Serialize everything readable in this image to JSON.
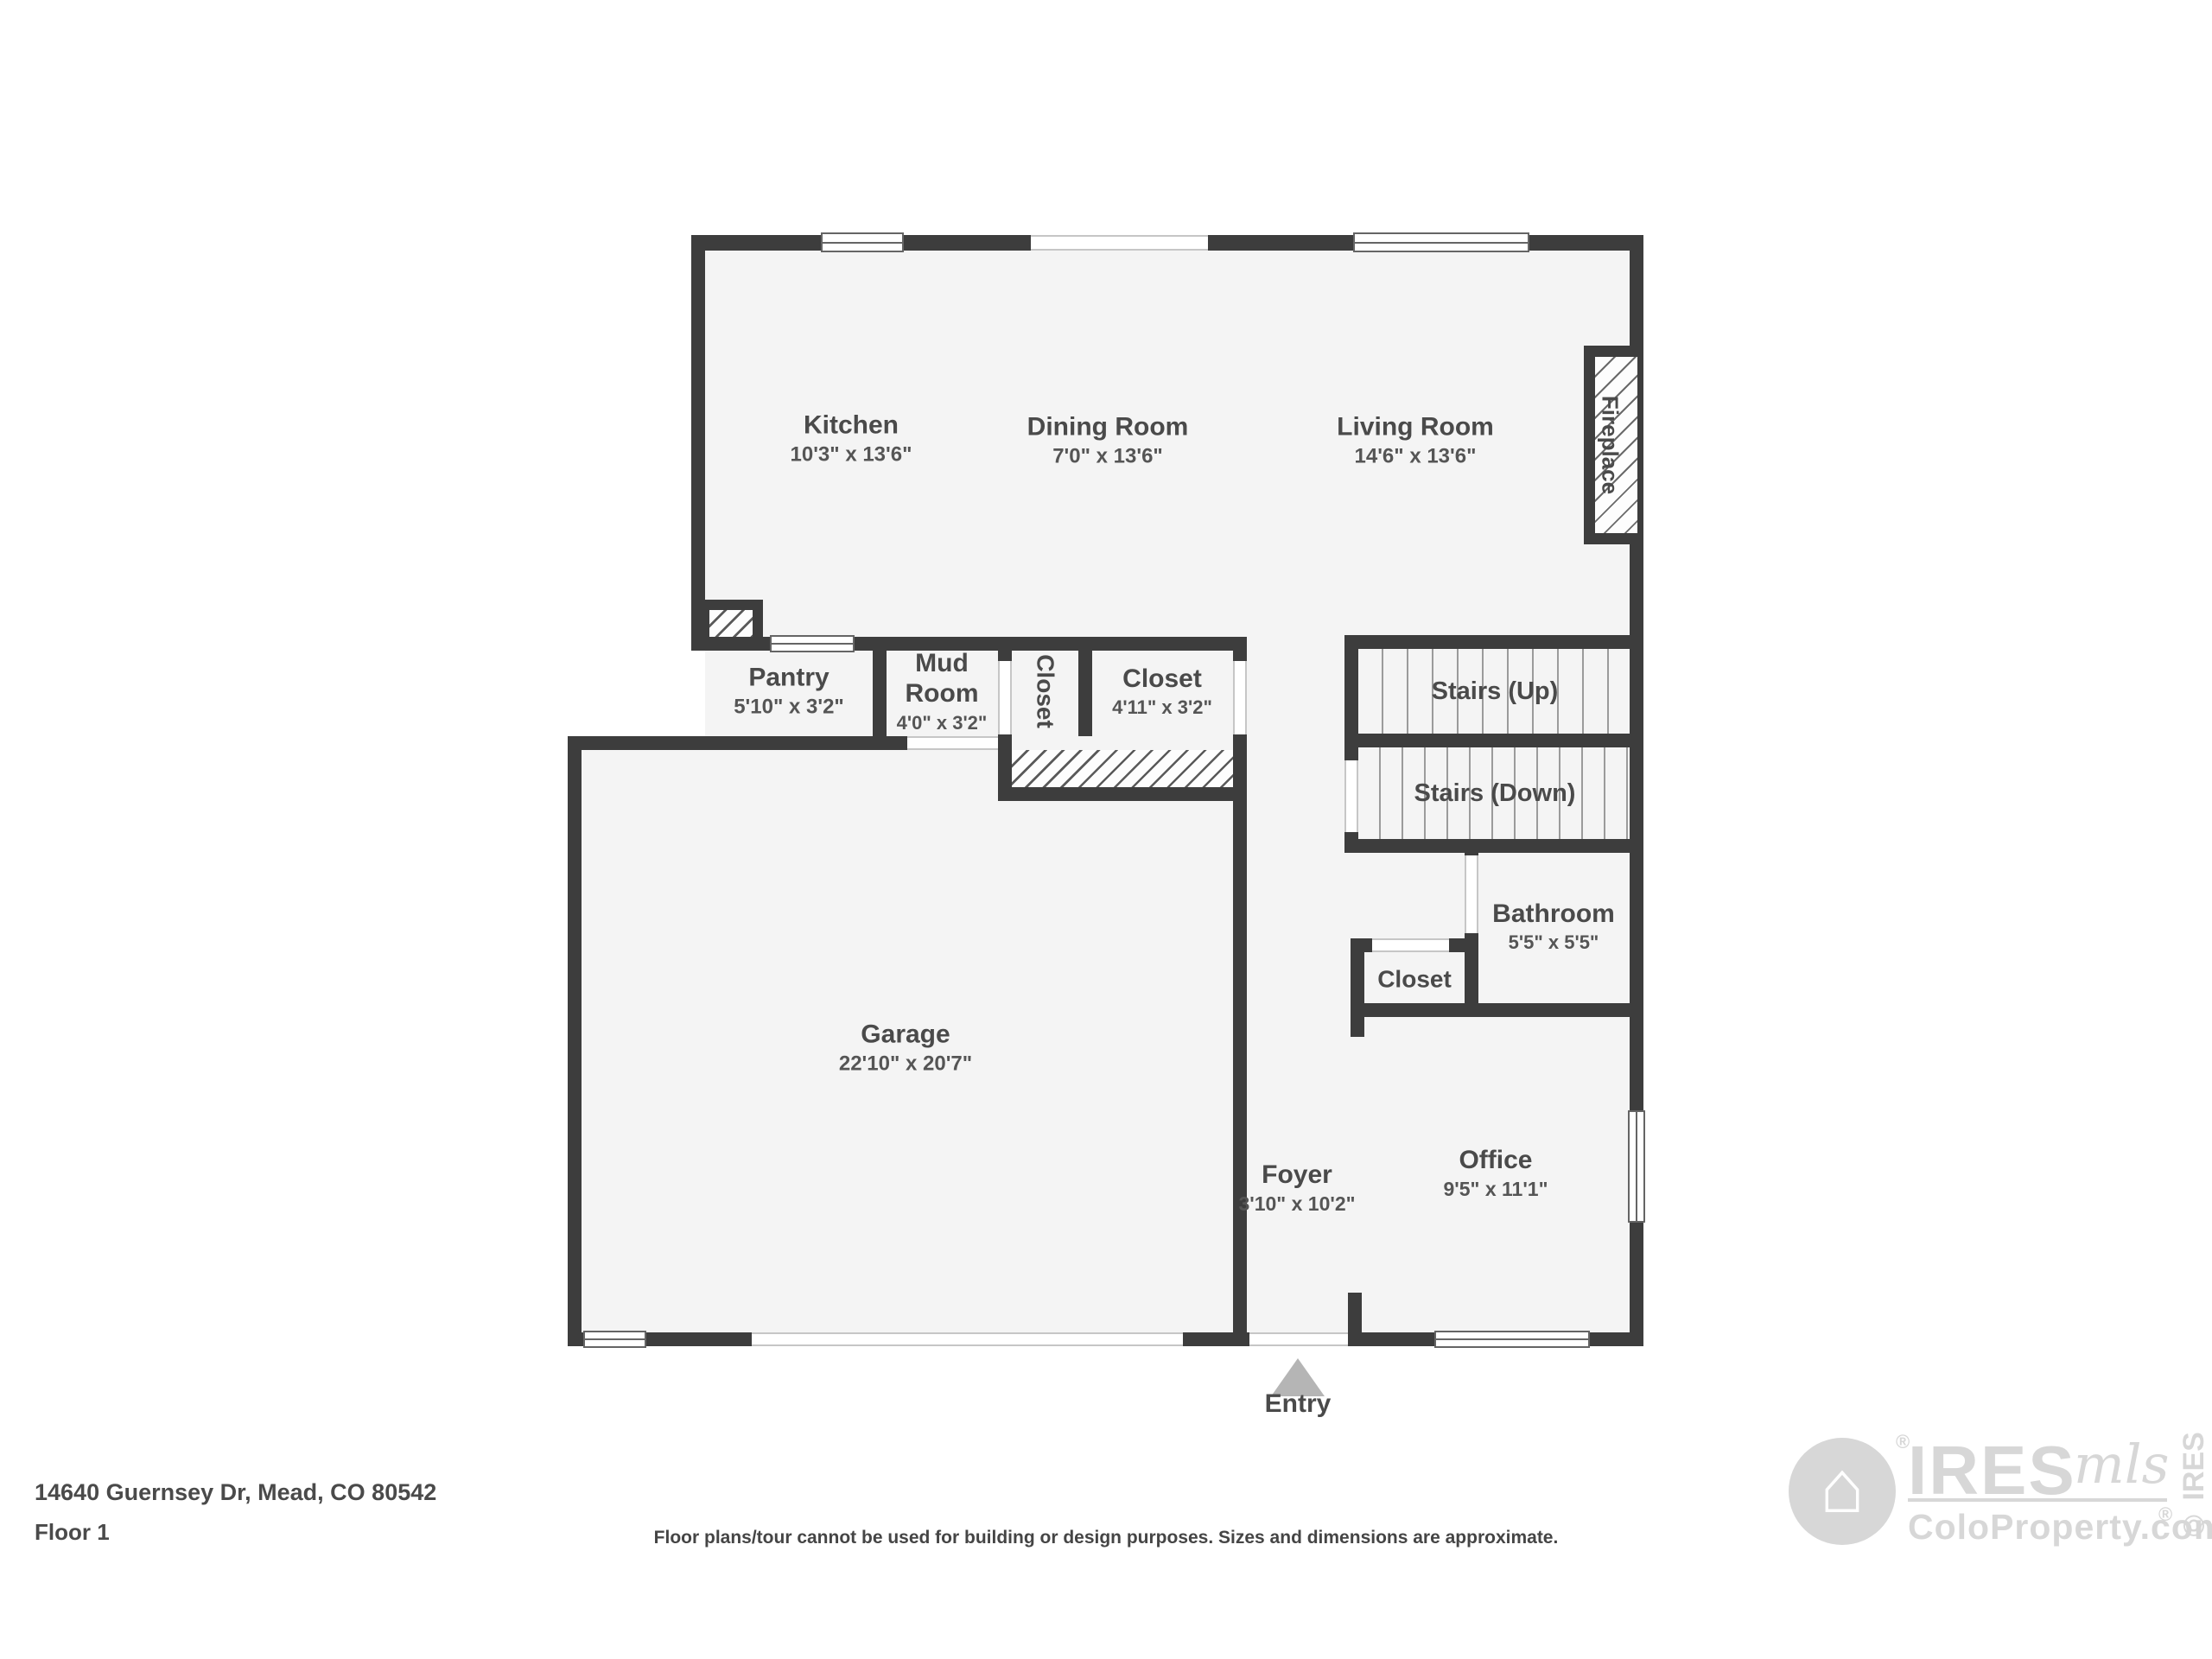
{
  "plan": {
    "rooms": {
      "kitchen": {
        "name": "Kitchen",
        "dims": "10'3\" x 13'6\""
      },
      "dining": {
        "name": "Dining Room",
        "dims": "7'0\" x 13'6\""
      },
      "living": {
        "name": "Living Room",
        "dims": "14'6\" x 13'6\""
      },
      "pantry": {
        "name": "Pantry",
        "dims": "5'10\" x 3'2\""
      },
      "mud_room": {
        "name": "Mud Room",
        "dims": "4'0\" x 3'2\""
      },
      "closet_hall": {
        "name": "Closet"
      },
      "closet_mud": {
        "name": "Closet",
        "dims": "4'11\" x 3'2\""
      },
      "stairs_up": {
        "name": "Stairs (Up)"
      },
      "stairs_down": {
        "name": "Stairs (Down)"
      },
      "bathroom": {
        "name": "Bathroom",
        "dims": "5'5\" x 5'5\""
      },
      "closet_bath": {
        "name": "Closet"
      },
      "garage": {
        "name": "Garage",
        "dims": "22'10\" x 20'7\""
      },
      "foyer": {
        "name": "Foyer",
        "dims": "3'10\" x 10'2\""
      },
      "office": {
        "name": "Office",
        "dims": "9'5\" x 11'1\""
      }
    },
    "features": {
      "fireplace": "Fireplace",
      "entry": "Entry"
    }
  },
  "footer": {
    "address": "14640 Guernsey Dr, Mead, CO 80542",
    "floor": "Floor 1",
    "disclaimer": "Floor plans/tour cannot be used for building or design purposes. Sizes and dimensions are approximate."
  },
  "branding": {
    "house_icon": "⌂",
    "name": "IRES",
    "suffix": "mls",
    "registered": "®",
    "site": "ColoProperty.com",
    "site_registered": "®",
    "copyright": "© IRES"
  },
  "colors": {
    "wall": "#3d3d3d",
    "floor": "#f4f4f4",
    "text": "#4a4a4a",
    "logo_gray": "#d7d7d7",
    "entry_triangle": "#b5b5b5"
  }
}
